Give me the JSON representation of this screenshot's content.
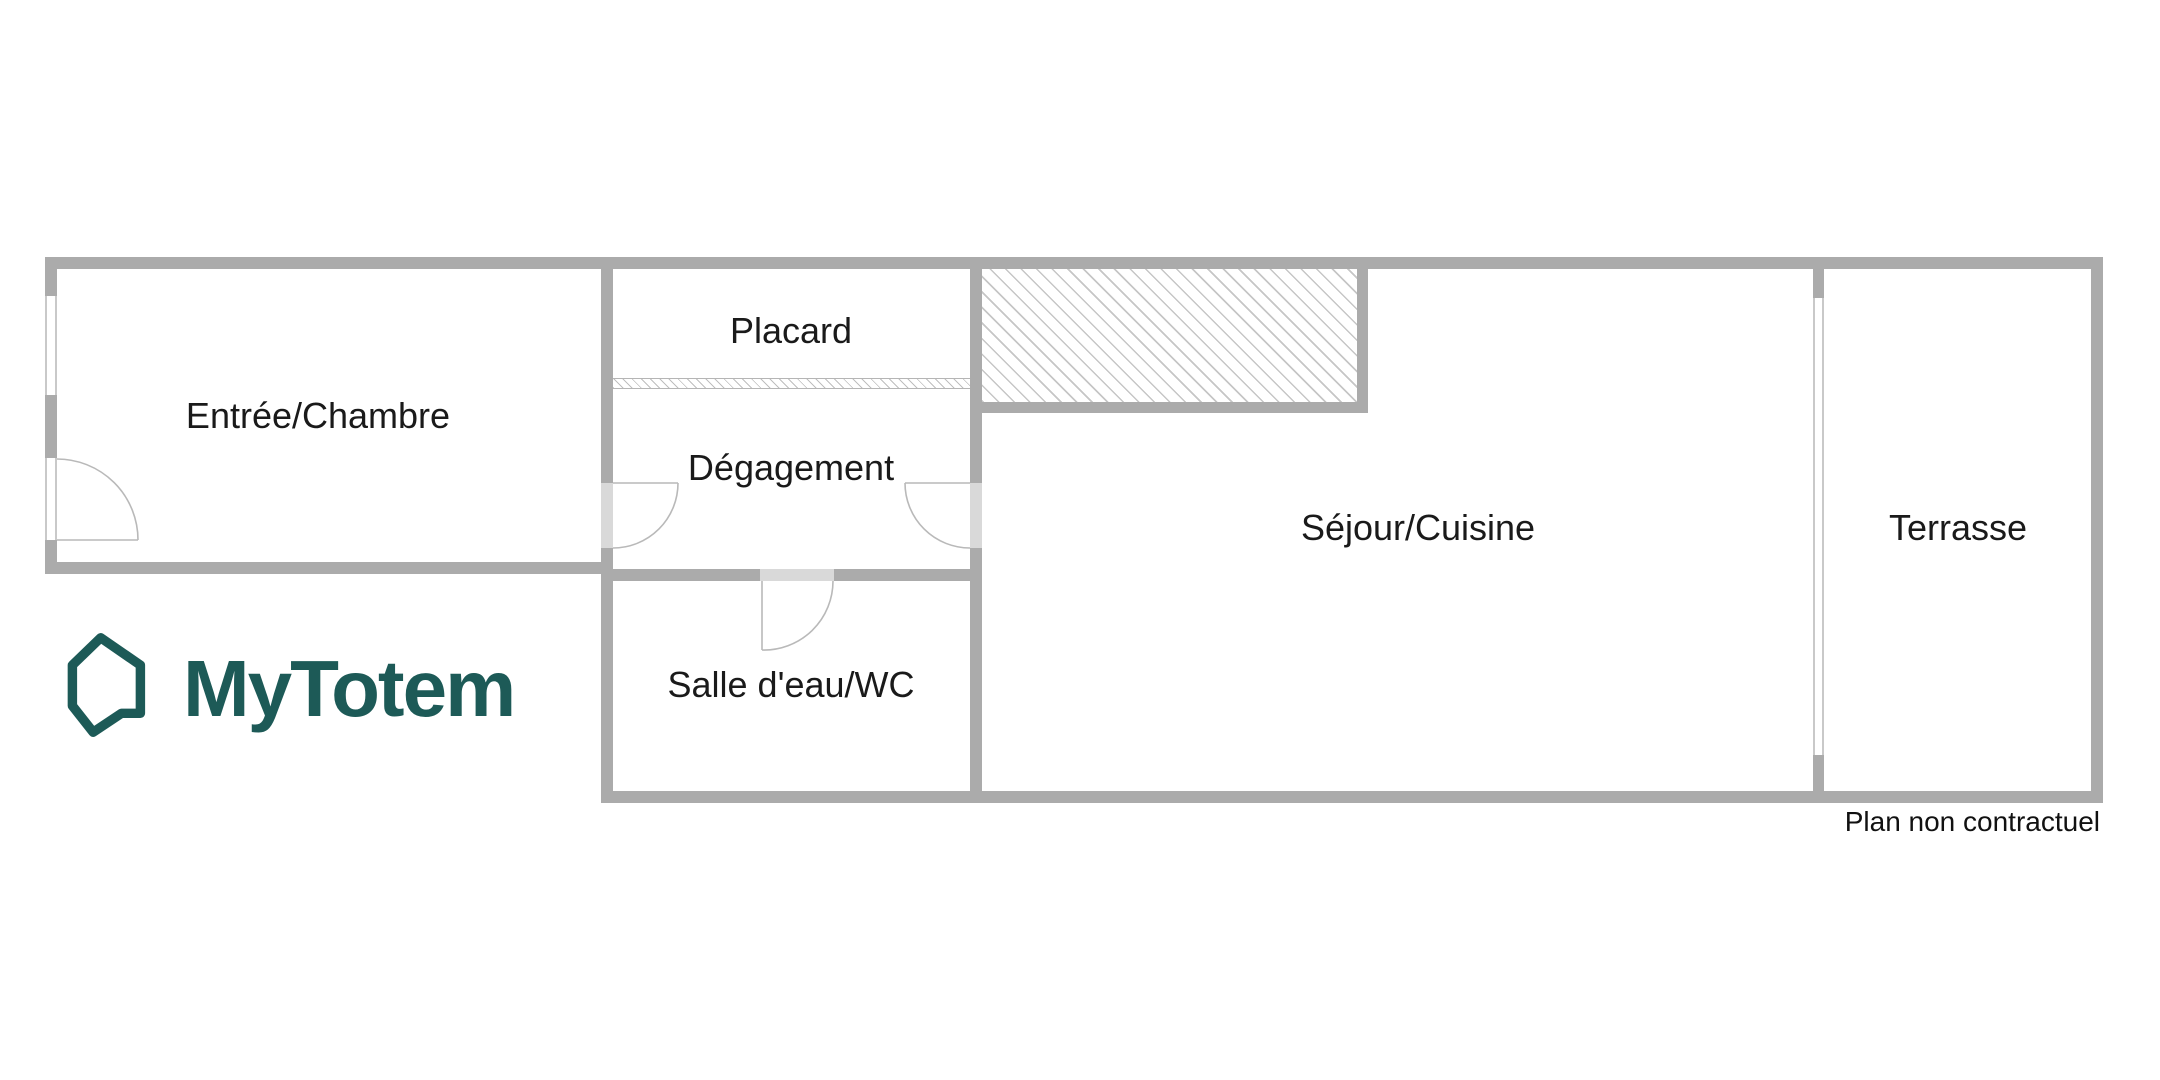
{
  "logo": {
    "brand": "MyTotem",
    "icon": "house-speech-bubble-icon"
  },
  "plan": {
    "rooms": {
      "entree": {
        "label": "Entrée/Chambre"
      },
      "placard": {
        "label": "Placard"
      },
      "degagement": {
        "label": "Dégagement"
      },
      "salle_eau": {
        "label": "Salle d'eau/WC"
      },
      "sejour": {
        "label": "Séjour/Cuisine"
      },
      "terrasse": {
        "label": "Terrasse"
      }
    },
    "disclaimer": "Plan non contractuel"
  },
  "colors": {
    "wall": "#ababab",
    "door_gap": "#d9d9d9",
    "hatch_line": "#c6c6c6",
    "arc_line": "#b9b9b9",
    "window_line": "#c9c9c9",
    "label_text": "#1a1a1a",
    "logo_teal": "#1d5a57"
  }
}
